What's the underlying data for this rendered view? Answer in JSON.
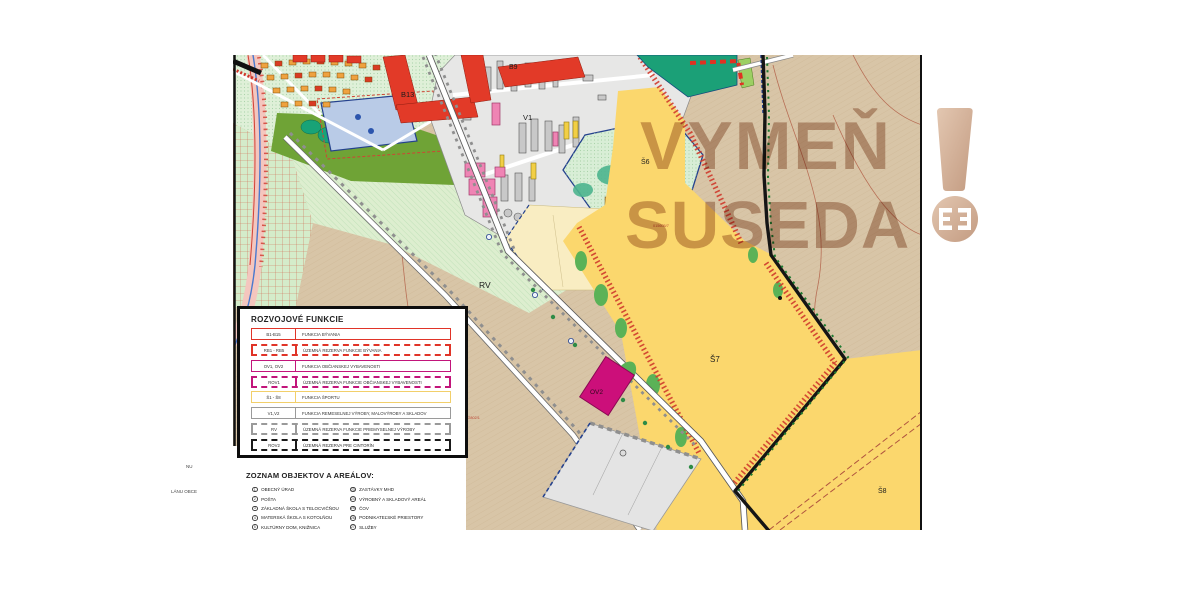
{
  "watermark": {
    "line1": "VYMEŇ",
    "line2": "SUSEDA",
    "color": "#a8765a"
  },
  "map": {
    "labels": {
      "b9": "B9",
      "b13": "B13",
      "v1": "V1",
      "s6": "Š6",
      "rv": "RV",
      "s7": "Š7",
      "ov2": "OV2",
      "s8": "Š8",
      "parcel1": "015605/7",
      "parcel2": "01/2802/1"
    },
    "edge_fragments": {
      "frag1": "NU",
      "frag2": "LÁNU OBCE"
    },
    "colors": {
      "farmland": "#d8c5a7",
      "sport_yellow": "#fbd76d",
      "pale_yellow": "#f9edc2",
      "residential_green": "#dff0d8",
      "olive_park": "#6fa336",
      "teal_trees": "#18a377",
      "industrial_gray": "#e7e7e6",
      "building_gray": "#c8c8c8",
      "building_pink": "#ef84b4",
      "civic_magenta": "#cc0f7a",
      "red_building": "#e23a28",
      "boundary_black": "#151515",
      "boundary_red_hatch": "#cf3a2c",
      "pond_blue": "#b9cbe7",
      "watermark_tan": "#c9a188"
    }
  },
  "legend": {
    "title": "ROZVOJOVÉ FUNKCIE",
    "rows": [
      {
        "code": "B1-B15",
        "label": "FUNKCIA BÝVANIA",
        "color": "#e03428",
        "style": "solid"
      },
      {
        "code": "RB1 - RB5",
        "label": "ÚZEMNÁ REZERVA FUNKCIE BÝVANIA",
        "color": "#e03428",
        "style": "dashed"
      },
      {
        "code": "OV1, OV2",
        "label": "FUNKCIA OBČIANSKEJ VYBAVENOSTI",
        "color": "#c2157b",
        "style": "solid"
      },
      {
        "code": "ROV1",
        "label": "ÚZEMNÁ REZERVA FUNKCIE OBČIANSKEJ VYBAVENOSTI",
        "color": "#c2157b",
        "style": "dashed"
      },
      {
        "code": "Š1 - Š8",
        "label": "FUNKCIA ŠPORTU",
        "color": "#f2cf6a",
        "style": "solid"
      },
      {
        "code": "V1,V2",
        "label": "FUNKCIA REMESELNEJ VÝROBY, MALOVÝROBY A SKLADOV",
        "color": "#9a9a9a",
        "style": "solid"
      },
      {
        "code": "RV",
        "label": "ÚZEMNÁ REZERVA FUNKCIE PRIEMYSELNEJ VÝROBY",
        "color": "#9a9a9a",
        "style": "dashed"
      },
      {
        "code": "ROV2",
        "label": "ÚZEMNÁ REZERVA PRE CINTORÍN",
        "color": "#1a1a1a",
        "style": "dashed"
      }
    ]
  },
  "objects": {
    "title": "ZOZNAM OBJEKTOV A AREÁLOV:",
    "left": [
      {
        "num": "1",
        "label": "OBECNÝ ÚRAD"
      },
      {
        "num": "2",
        "label": "POŠTA"
      },
      {
        "num": "3",
        "label": "ZÁKLADNÁ ŠKOLA S TELOCVIČŇOU"
      },
      {
        "num": "4",
        "label": "MATERSKÁ ŠKOLA S KOTOLŇOU"
      },
      {
        "num": "5",
        "label": "KULTÚRNY DOM, KNIŽNICA"
      }
    ],
    "right": [
      {
        "num": "23",
        "label": "ZASTÁVKY MHD"
      },
      {
        "num": "24",
        "label": "VÝROBNÝ A SKLADOVÝ AREÁL"
      },
      {
        "num": "25",
        "label": "ČOV"
      },
      {
        "num": "26",
        "label": "PODNIKATEĽSKÉ PRIESTORY"
      },
      {
        "num": "27",
        "label": "SLUŽBY"
      }
    ]
  }
}
